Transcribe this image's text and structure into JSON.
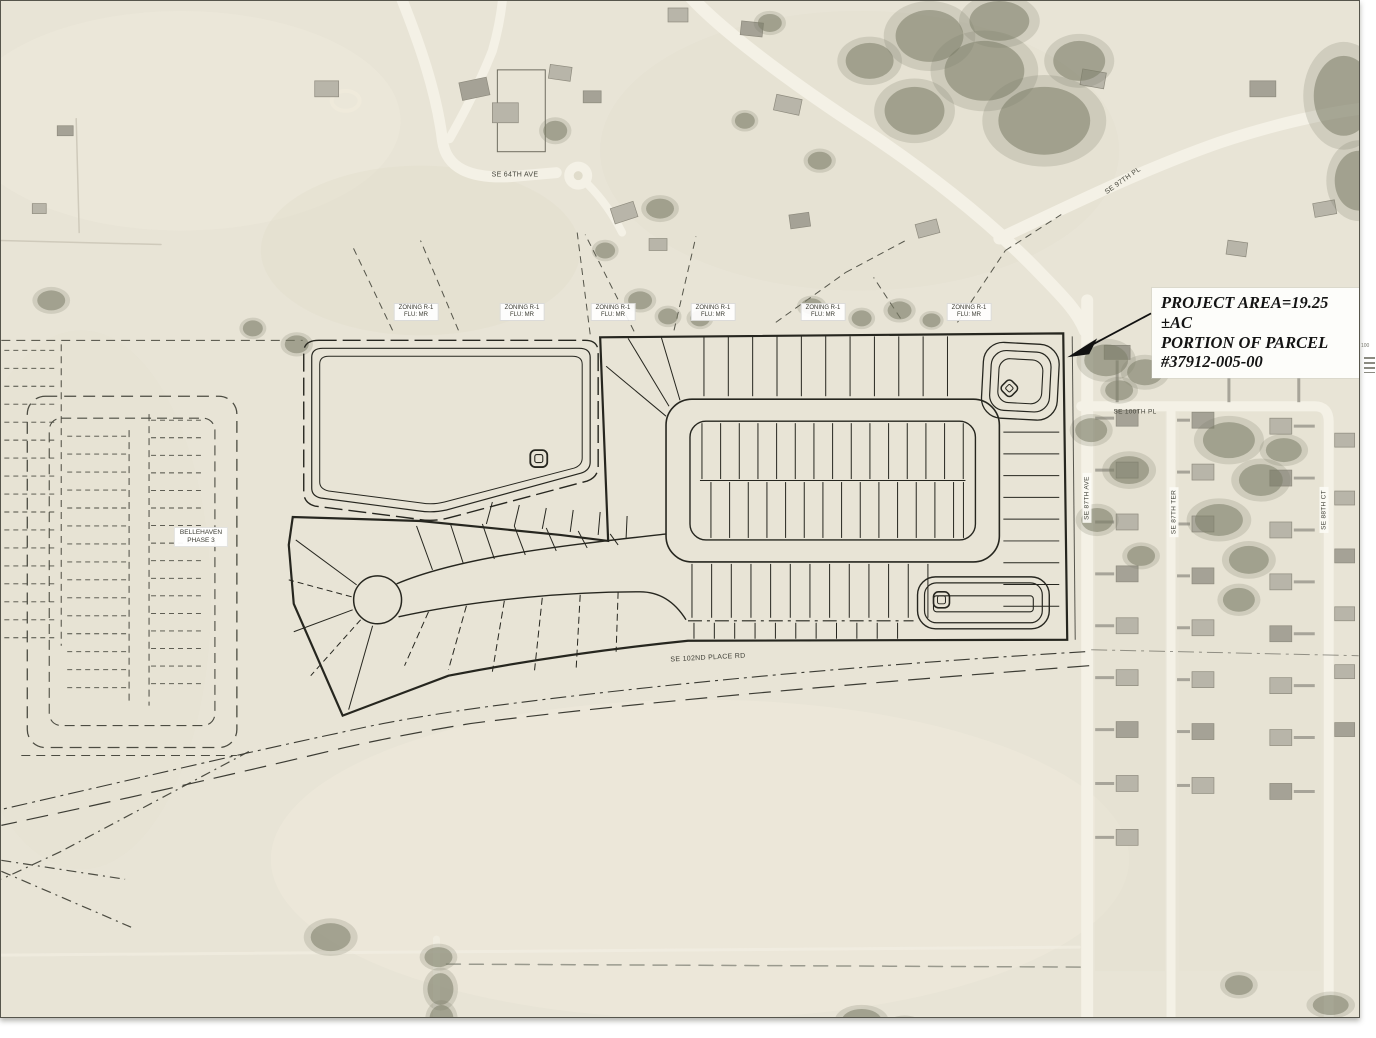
{
  "annotation": {
    "project_area": {
      "line1": "PROJECT AREA=19.25 ±AC",
      "line2": "PORTION OF PARCEL",
      "line3": "#37912-005-00"
    }
  },
  "zoning": {
    "items": [
      {
        "line1": "ZONING R-1",
        "line2": "FLU: MR"
      },
      {
        "line1": "ZONING R-1",
        "line2": "FLU: MR"
      },
      {
        "line1": "ZONING R-1",
        "line2": "FLU: MR"
      },
      {
        "line1": "ZONING R-1",
        "line2": "FLU: MR"
      },
      {
        "line1": "ZONING R-1",
        "line2": "FLU: MR"
      },
      {
        "line1": "ZONING R-1",
        "line2": "FLU: MR"
      }
    ]
  },
  "subdivision_label": {
    "line1": "BELLEHAVEN",
    "line2": "PHASE 3"
  },
  "streets": {
    "se_64th_ave": "SE 64TH AVE",
    "se_97th_pl": "SE 97TH PL",
    "se_100th_pl": "SE 100TH PL",
    "se_87th_ave": "SE 87TH AVE",
    "se_87th_ter": "SE 87TH TER",
    "se_88th_ct": "SE 88TH CT",
    "se_102nd_place_rd": "SE 102ND PLACE RD"
  },
  "margin": {
    "scale_text": "100"
  },
  "colors": {
    "aerial_base": "#e8e4d6",
    "aerial_road": "#f4f1e6",
    "plan_line": "#26261f",
    "plat_line": "#4c4c42",
    "tree": "#7b7d68",
    "house_fill": "#b8b5a9",
    "house_stroke": "#8e8b7e",
    "driveway": "#a7a499",
    "label_bg": "#ffffff"
  }
}
